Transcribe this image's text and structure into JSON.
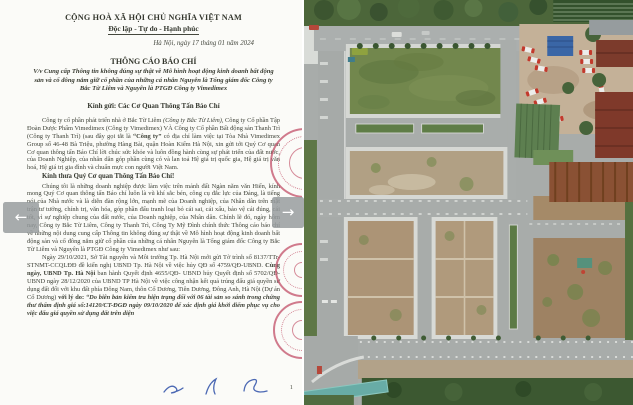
{
  "carousel": {
    "prev_icon": "←",
    "next_icon": "→"
  },
  "document": {
    "header": {
      "national": "CỘNG HOÀ XÃ HỘI CHỦ NGHĨA VIỆT NAM",
      "motto": "Độc lập - Tự do - Hạnh phúc",
      "dateline": "Hà Nội, ngày 17 tháng 01 năm 2024"
    },
    "title": "THÔNG CÁO BÁO CHÍ",
    "subject": "V/v Cung cấp Thông tin không đúng sự thật về Mô hình hoạt động kinh doanh bất động sản và cổ đông nắm giữ cổ phần của những cá nhân Nguyên là Tổng giám đốc Công ty Bắc Từ Liêm và Nguyên là PTGĐ Công ty Vimedimex",
    "salutation": "Kính gửi: Các Cơ Quan Thông Tấn Báo Chí",
    "para1": {
      "s1": "Công ty cổ phần phát triển nhà ở Bắc Từ Liêm ",
      "s2": "(Công ty Bắc Từ Liêm),",
      "s3": " Công ty Cổ phần Tập Đoàn Dược Phẩm Vimedimex (Công ty Vimedimex) VÀ Công ty Cổ phần Bất động sản Thanh Trì (Công ty Thanh Trì) (sau đây gọi tắt là ",
      "s4": "“Công ty”",
      "s5": " có địa chỉ làm việc tại Tòa Nhà Vimedimex Group số 46-48 Bà Triệu, phường Hàng Bài, quận Hoàn Kiếm Hà Nội, xin gửi tới Quý Cơ quan Cơ quan thông tấn Báo Chí lời chúc sức khỏe và luôn đồng hành cùng sự phát triển của đất nước, của Doanh Nghiệp, của nhân dân góp phần cùng có và lan toả Hệ giá trị quốc gia, Hệ giá trị văn hoá, Hệ giá trị gia đình và chuẩn mực con người Việt Nam."
    },
    "heading2": "Kính thưa Quý Cơ quan Thông Tấn Báo Chí!",
    "para2": "Chúng tôi là những doanh nghiệp được làm việc trên mảnh đất Ngàn năm văn Hiến, kính mong Quý Cơ quan thông tấn Báo chí luôn là vũ khí sắc bén, công cụ đắc lực của Đảng, là tiếng nói của Nhà nước và là diễn đàn rộng lớn, mạnh mẽ của Doanh nghiệp, của Nhân dân trên mặt trận tư tưởng, chính trị, văn hóa, góp phần đấu tranh loại bỏ cái sai, cái xấu, bảo vệ cái đúng, cái tốt, vì sự nghiệp chung của đất nước, của Doanh nghiệp, của Nhân dân. Chính lẽ đó, ngày hôm nay, Công ty Bắc Từ Liêm, Công ty Thanh Trì, Công Ty Mỹ Đình chính thức Thông cáo báo chí về những nội dung cung cấp Thông tin không đúng sự thật về Mô hình hoạt động kinh doanh bất động sản và cổ đông nắm giữ cổ phần của những cá nhân Nguyên là Tổng giám đốc Công ty Bắc Từ Liêm và Nguyên là PTGĐ Công ty Vimedimex như sau:",
    "para3": {
      "s1": "Ngày 29/10/2021, Sở Tài nguyên và Môi trường Tp. Hà Nội mới gửi Tờ trình số 8137/TTr-STNMT-CCQLĐĐ đề kiến nghị UBND Tp. Hà Nội về việc hủy QĐ số 4759/QĐ-UBND. ",
      "s2": "Cùng ngày, UBND Tp. Hà Nội",
      "s3": " ban hành Quyết định 4655/QĐ- UBND hủy Quyết định số 5702/QĐ-UBND ngày 28/12/2020 của UBND TP Hà Nội về việc công nhận kết quả trúng đấu giá quyền sử dụng đất đối với khu đất phía Đông Nam, thôn Cổ Dương, Tiên Dương, Đông Anh, Hà Nội (Dự án Cổ Dương) ",
      "s4": "với lý do: ",
      "s5": "“Do biên bản kiểm tra hiện trạng đối với 06 tài sản so sánh trong chứng thư thẩm định giá số:14120/CT-ĐGĐ ngày 09/10/2020 để xác định giá khởi điểm phục vụ cho việc đấu giá quyền sử dụng đất trên diện"
    },
    "page_number": "1"
  },
  "colors": {
    "stamp_red": "#c3546b",
    "arrow_bg": "#969b9d",
    "signature_blue": "#2d4fa8",
    "field_green": "#72874d",
    "plot_dirt": "#b09878",
    "road_gray": "#a8acaa"
  }
}
